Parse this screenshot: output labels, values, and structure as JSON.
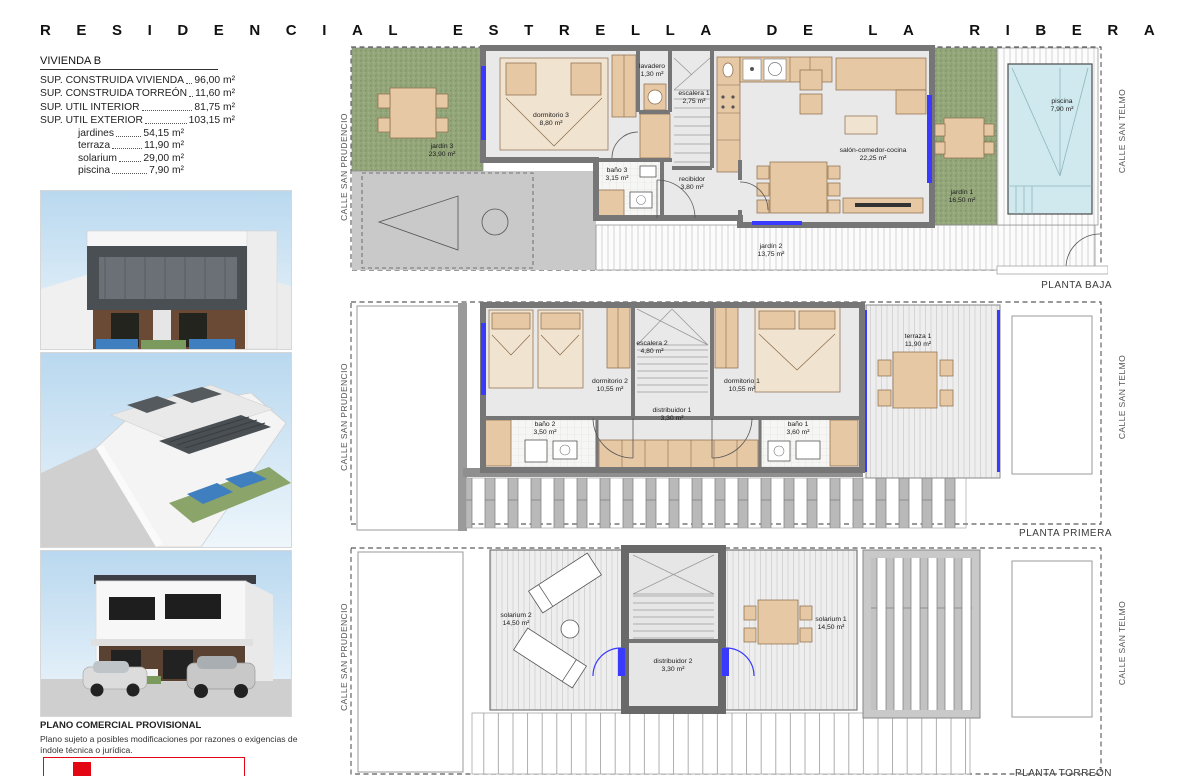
{
  "title": "RESIDENCIAL ESTRELLA DE LA RIBERA",
  "unit": {
    "heading": "VIVIENDA B",
    "specs": [
      {
        "label": "SUP. CONSTRUIDA VIVIENDA",
        "value": "96,00 m²"
      },
      {
        "label": "SUP. CONSTRUIDA TORREÓN",
        "value": "11,60 m²"
      },
      {
        "label": "SUP. UTIL INTERIOR",
        "value": "81,75 m²"
      },
      {
        "label": "SUP. UTIL EXTERIOR",
        "value": "103,15 m²"
      },
      {
        "label": "jardines",
        "value": "54,15 m²"
      },
      {
        "label": "terraza",
        "value": "11,90 m²"
      },
      {
        "label": "solarium",
        "value": "29,00 m²"
      },
      {
        "label": "piscina",
        "value": "7,90 m²"
      }
    ]
  },
  "streets": {
    "left": "CALLE SAN PRUDENCIO",
    "right": "CALLE SAN TELMO"
  },
  "plans": {
    "baja": {
      "label": "PLANTA BAJA",
      "rooms": {
        "jardin3": {
          "name": "jardín 3",
          "area": "23,90 m²"
        },
        "dormitorio3": {
          "name": "dormitorio 3",
          "area": "8,80 m²"
        },
        "lavadero": {
          "name": "lavadero",
          "area": "1,30 m²"
        },
        "escalera1": {
          "name": "escalera 1",
          "area": "2,75 m²"
        },
        "bano3": {
          "name": "baño 3",
          "area": "3,15 m²"
        },
        "recibidor": {
          "name": "recibidor",
          "area": "3,80 m²"
        },
        "salon": {
          "name": "salón-comedor-cocina",
          "area": "22,25 m²"
        },
        "jardin1": {
          "name": "jardín 1",
          "area": "16,50 m²"
        },
        "jardin2": {
          "name": "jardín 2",
          "area": "13,75 m²"
        },
        "piscina": {
          "name": "piscina",
          "area": "7,90 m²"
        }
      }
    },
    "primera": {
      "label": "PLANTA PRIMERA",
      "rooms": {
        "dormitorio2": {
          "name": "dormitorio 2",
          "area": "10,55 m²"
        },
        "escalera2": {
          "name": "escalera 2",
          "area": "4,80 m²"
        },
        "distribuidor1": {
          "name": "distribuidor 1",
          "area": "3,30 m²"
        },
        "dormitorio1": {
          "name": "dormitorio 1",
          "area": "10,55 m²"
        },
        "bano2": {
          "name": "baño 2",
          "area": "3,50 m²"
        },
        "bano1": {
          "name": "baño 1",
          "area": "3,60 m²"
        },
        "terraza1": {
          "name": "terraza 1",
          "area": "11,90 m²"
        }
      }
    },
    "torreon": {
      "label": "PLANTA TORREÓN",
      "rooms": {
        "solarium2": {
          "name": "solarium 2",
          "area": "14,50 m²"
        },
        "solarium1": {
          "name": "solarium 1",
          "area": "14,50 m²"
        },
        "distribuidor2": {
          "name": "distribuidor 2",
          "area": "3,30 m²"
        }
      }
    }
  },
  "footer": {
    "title": "PLANO COMERCIAL PROVISIONAL",
    "line1": "Plano sujeto a posibles modificaciones por razones o exigencias de",
    "line2": "índole técnica o jurídica."
  },
  "colors": {
    "grass": "#94a77a",
    "pool": "#cfe9ee",
    "wall": "#767676",
    "furniture": "#e6c8a4",
    "window_blue": "#3a3aff",
    "logo_red": "#e30613"
  }
}
